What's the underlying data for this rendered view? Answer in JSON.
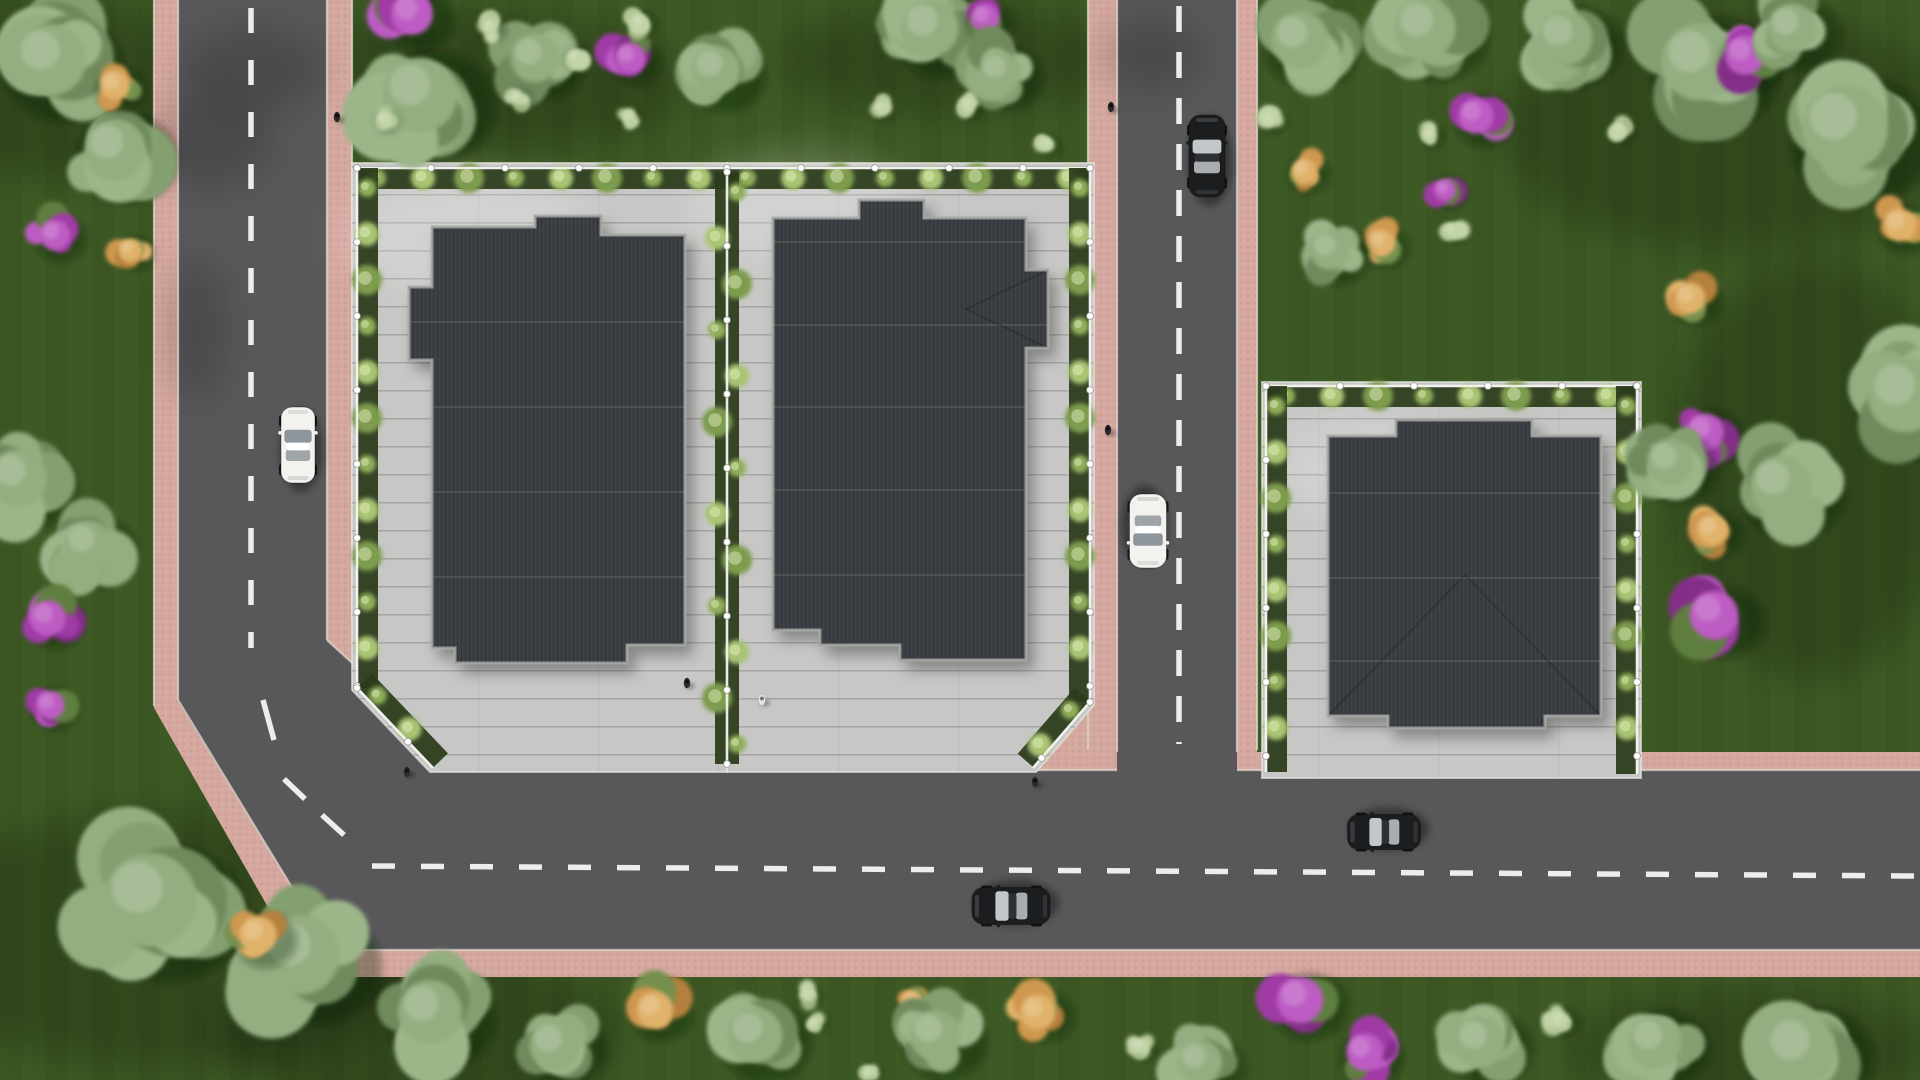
{
  "scene": {
    "width": 1920,
    "height": 1080,
    "description": "Aerial top-down 3D architectural render: three paved plots with dark flat stepped roofs, pink-edged asphalt roads, cars and landscaped lawns"
  },
  "palette": {
    "grass": "#3d5a24",
    "grass_stripe": "rgba(10,28,4,0.05)",
    "grass_shade": "rgba(8,20,3,0.20)",
    "asphalt": "#58585a",
    "asphalt_shade": "rgba(20,22,20,0.16)",
    "sidewalk": "#d5a89f",
    "sidewalk_speckle_dark": "rgba(100,55,48,0.18)",
    "sidewalk_speckle_light": "rgba(255,240,235,0.20)",
    "curb": "#ded2c9",
    "paving": "#c7c7c5",
    "paving_line": "rgba(100,100,98,0.32)",
    "paving_light": "rgba(255,255,255,0.20)",
    "roof": "#3e4144",
    "roof_seam": "rgba(0,0,0,0.20)",
    "roof_joint": "rgba(255,255,255,0.10)",
    "roof_trim": "#a3a7a5",
    "roof_hip": "rgba(0,0,0,0.18)",
    "hedge": "#2c3b1b",
    "hedge_plant_a": "#8fae5a",
    "hedge_plant_b": "#a9c473",
    "hedge_plant_c": "#7d9c4e",
    "fence": "#f4f4f2",
    "fence_post_stroke": "#9a9a96",
    "marking": "#f5f5f3",
    "car_white_body": "#f2f2ef",
    "car_white_glass": "#8f969b",
    "car_black_body": "#1b1d1f",
    "car_black_glass": "#c2c7c9",
    "person_dark": "#2b2b2d",
    "person_light": "#e8e8e6",
    "tree_sage": [
      "#84a071",
      "#93ae80",
      "#6f8a5d",
      "#9cb68a"
    ],
    "bush_light": [
      "#b5c998",
      "#c3d4a8",
      "#9db37e"
    ],
    "bush_orange": [
      "#cf9850",
      "#e0b26b",
      "#b5803c",
      "#74904e"
    ],
    "bush_purple": [
      "#a03ba6",
      "#bd5cc3",
      "#832f88",
      "#5e7f3f"
    ]
  },
  "roads": {
    "sidewalk_polygons": [
      {
        "name": "l-road-sidewalk",
        "points": [
          [
            154,
            0
          ],
          [
            352,
            0
          ],
          [
            352,
            622
          ],
          [
            470,
            752
          ],
          [
            1920,
            752
          ],
          [
            1920,
            977
          ],
          [
            308,
            977
          ],
          [
            154,
            708
          ]
        ]
      },
      {
        "name": "vertical-road-sidewalk",
        "points": [
          [
            1088,
            0
          ],
          [
            1257,
            0
          ],
          [
            1257,
            752
          ],
          [
            1088,
            752
          ]
        ]
      },
      {
        "name": "junction-corner-sidewalk-wedge",
        "points": [
          [
            1033,
            775
          ],
          [
            1098,
            700
          ],
          [
            1120,
            775
          ]
        ]
      }
    ],
    "asphalt_polygons": [
      {
        "name": "l-road-asphalt",
        "points": [
          [
            178,
            0
          ],
          [
            327,
            0
          ],
          [
            327,
            640
          ],
          [
            470,
            770
          ],
          [
            1920,
            770
          ],
          [
            1920,
            950
          ],
          [
            330,
            950
          ],
          [
            178,
            702
          ]
        ]
      },
      {
        "name": "vertical-road-asphalt",
        "points": [
          [
            1117,
            0
          ],
          [
            1237,
            0
          ],
          [
            1237,
            770
          ],
          [
            1117,
            770
          ]
        ]
      }
    ],
    "curb_lines": [
      [
        178,
        0,
        178,
        700
      ],
      [
        327,
        0,
        327,
        640
      ],
      [
        327,
        640,
        470,
        770
      ],
      [
        178,
        700,
        330,
        950
      ],
      [
        330,
        950,
        1920,
        950
      ],
      [
        470,
        770,
        1117,
        770
      ],
      [
        1237,
        770,
        1920,
        770
      ],
      [
        1117,
        0,
        1117,
        752
      ],
      [
        1237,
        0,
        1237,
        752
      ],
      [
        154,
        0,
        154,
        706
      ],
      [
        352,
        0,
        352,
        620
      ],
      [
        1088,
        0,
        1088,
        750
      ],
      [
        1257,
        0,
        1257,
        750
      ]
    ],
    "center_dash_lines": [
      {
        "name": "left-road-center-line",
        "x1": 251,
        "y1": 8,
        "x2": 251,
        "y2": 648,
        "dash": "25 27"
      },
      {
        "name": "vertical-road-center-line",
        "x1": 1179,
        "y1": 6,
        "x2": 1179,
        "y2": 744,
        "dash": "26 20"
      },
      {
        "name": "horizontal-road-center-line",
        "x1": 372,
        "y1": 866,
        "x2": 1914,
        "y2": 876,
        "dash": "23 26"
      },
      {
        "name": "bend-dash-1",
        "x1": 263,
        "y1": 700,
        "x2": 274,
        "y2": 740,
        "dash": "none"
      },
      {
        "name": "bend-dash-2",
        "x1": 284,
        "y1": 779,
        "x2": 305,
        "y2": 799,
        "dash": "none"
      },
      {
        "name": "bend-dash-3",
        "x1": 322,
        "y1": 815,
        "x2": 344,
        "y2": 835,
        "dash": "none"
      }
    ],
    "tree_shadows_on_asphalt": [
      {
        "x": 210,
        "y": 140,
        "rx": 62,
        "ry": 48
      },
      {
        "x": 196,
        "y": 330,
        "rx": 30,
        "ry": 72
      },
      {
        "x": 252,
        "y": 70,
        "rx": 72,
        "ry": 42
      },
      {
        "x": 1150,
        "y": 55,
        "rx": 52,
        "ry": 36
      }
    ]
  },
  "plots": [
    {
      "name": "plot-1",
      "points": [
        [
          352,
          163
        ],
        [
          727,
          163
        ],
        [
          727,
          772
        ],
        [
          430,
          772
        ],
        [
          352,
          690
        ]
      ]
    },
    {
      "name": "plot-2",
      "points": [
        [
          727,
          163
        ],
        [
          1094,
          163
        ],
        [
          1094,
          705
        ],
        [
          1036,
          772
        ],
        [
          727,
          772
        ]
      ]
    },
    {
      "name": "plot-3",
      "points": [
        [
          1262,
          382
        ],
        [
          1641,
          382
        ],
        [
          1641,
          778
        ],
        [
          1262,
          778
        ]
      ]
    }
  ],
  "paving_light_patches": [
    {
      "x": 470,
      "y": 235,
      "rx": 125,
      "ry": 62
    },
    {
      "x": 800,
      "y": 205,
      "rx": 110,
      "ry": 55
    },
    {
      "x": 1380,
      "y": 470,
      "rx": 100,
      "ry": 50
    }
  ],
  "grass_shade_patches": [
    {
      "x": 450,
      "y": 85,
      "rx": 240,
      "ry": 70
    },
    {
      "x": 950,
      "y": 60,
      "rx": 170,
      "ry": 55
    },
    {
      "x": 1730,
      "y": 130,
      "rx": 230,
      "ry": 120
    },
    {
      "x": 170,
      "y": 940,
      "rx": 260,
      "ry": 130
    },
    {
      "x": 1810,
      "y": 470,
      "rx": 140,
      "ry": 210
    },
    {
      "x": 60,
      "y": 90,
      "rx": 140,
      "ry": 90
    },
    {
      "x": 420,
      "y": 1030,
      "rx": 200,
      "ry": 80
    },
    {
      "x": 1750,
      "y": 1050,
      "rx": 180,
      "ry": 60
    }
  ],
  "fences": [
    {
      "name": "plot1-top-fence",
      "x1": 357,
      "y1": 168,
      "x2": 727,
      "y2": 168,
      "nx": 0,
      "ny": 1
    },
    {
      "name": "plot1-left-fence",
      "x1": 357,
      "y1": 168,
      "x2": 357,
      "y2": 688,
      "nx": 1,
      "ny": 0
    },
    {
      "name": "plot1-corner-fence",
      "x1": 357,
      "y1": 688,
      "x2": 433,
      "y2": 768,
      "nx": 0.7,
      "ny": -0.7
    },
    {
      "name": "plot2-top-fence",
      "x1": 727,
      "y1": 168,
      "x2": 1090,
      "y2": 168,
      "nx": 0,
      "ny": 1
    },
    {
      "name": "plot2-right-fence",
      "x1": 1090,
      "y1": 168,
      "x2": 1090,
      "y2": 702,
      "nx": -1,
      "ny": 0
    },
    {
      "name": "plot2-corner-fence",
      "x1": 1090,
      "y1": 702,
      "x2": 1033,
      "y2": 768,
      "nx": -0.7,
      "ny": -0.7
    },
    {
      "name": "interplot-fence",
      "x1": 727,
      "y1": 172,
      "x2": 727,
      "y2": 764,
      "nx": 0,
      "ny": 0
    },
    {
      "name": "plot3-top-fence",
      "x1": 1266,
      "y1": 386,
      "x2": 1637,
      "y2": 386,
      "nx": 0,
      "ny": 1
    },
    {
      "name": "plot3-left-fence",
      "x1": 1266,
      "y1": 386,
      "x2": 1266,
      "y2": 772,
      "nx": 1,
      "ny": 0
    },
    {
      "name": "plot3-right-fence",
      "x1": 1637,
      "y1": 386,
      "x2": 1637,
      "y2": 774,
      "nx": -1,
      "ny": 0
    }
  ],
  "buildings": [
    {
      "name": "building-1-roof",
      "points": [
        [
          432,
          227
        ],
        [
          535,
          227
        ],
        [
          535,
          216
        ],
        [
          601,
          216
        ],
        [
          601,
          235
        ],
        [
          685,
          235
        ],
        [
          685,
          645
        ],
        [
          627,
          645
        ],
        [
          627,
          663
        ],
        [
          455,
          663
        ],
        [
          455,
          648
        ],
        [
          432,
          648
        ],
        [
          432,
          360
        ],
        [
          409,
          360
        ],
        [
          409,
          287
        ],
        [
          432,
          287
        ]
      ],
      "joint_lines_y": [
        322,
        407,
        492,
        577
      ],
      "hips": []
    },
    {
      "name": "building-2-roof",
      "points": [
        [
          773,
          218
        ],
        [
          859,
          218
        ],
        [
          859,
          200
        ],
        [
          924,
          200
        ],
        [
          924,
          218
        ],
        [
          1026,
          218
        ],
        [
          1026,
          270
        ],
        [
          1048,
          270
        ],
        [
          1048,
          348
        ],
        [
          1026,
          348
        ],
        [
          1026,
          660
        ],
        [
          900,
          660
        ],
        [
          900,
          645
        ],
        [
          820,
          645
        ],
        [
          820,
          630
        ],
        [
          773,
          630
        ]
      ],
      "joint_lines_y": [
        242,
        325,
        407,
        490,
        575
      ],
      "hips": [
        [
          1048,
          270,
          966,
          309
        ],
        [
          1048,
          348,
          966,
          309
        ]
      ]
    },
    {
      "name": "building-3-roof",
      "points": [
        [
          1328,
          436
        ],
        [
          1396,
          436
        ],
        [
          1396,
          420
        ],
        [
          1532,
          420
        ],
        [
          1532,
          436
        ],
        [
          1601,
          436
        ],
        [
          1601,
          716
        ],
        [
          1545,
          716
        ],
        [
          1545,
          728
        ],
        [
          1388,
          728
        ],
        [
          1388,
          716
        ],
        [
          1328,
          716
        ]
      ],
      "joint_lines_y": [
        493,
        578,
        661
      ],
      "hips": [
        [
          1328,
          716,
          1465,
          575
        ],
        [
          1601,
          716,
          1465,
          575
        ]
      ]
    }
  ],
  "vegetation": [
    [
      "tree",
      50,
      60,
      65
    ],
    [
      "tree",
      115,
      150,
      56
    ],
    [
      "orange",
      115,
      85,
      27
    ],
    [
      "orange",
      130,
      250,
      21
    ],
    [
      "purple",
      55,
      235,
      28
    ],
    [
      "tree",
      18,
      478,
      52
    ],
    [
      "tree",
      88,
      545,
      44
    ],
    [
      "purple",
      48,
      618,
      32
    ],
    [
      "purple",
      50,
      705,
      26
    ],
    [
      "tree",
      150,
      900,
      85
    ],
    [
      "tree",
      300,
      955,
      72
    ],
    [
      "orange",
      258,
      935,
      34
    ],
    [
      "tree",
      430,
      1012,
      58
    ],
    [
      "tree",
      555,
      1045,
      46
    ],
    [
      "purple",
      412,
      14,
      38
    ],
    [
      "tree",
      420,
      95,
      68
    ],
    [
      "tree",
      535,
      58,
      44
    ],
    [
      "bush",
      490,
      27,
      15
    ],
    [
      "bush",
      517,
      97,
      13
    ],
    [
      "bush",
      385,
      120,
      13
    ],
    [
      "bush",
      575,
      57,
      15
    ],
    [
      "purple",
      630,
      58,
      28
    ],
    [
      "bush",
      640,
      22,
      15
    ],
    [
      "bush",
      628,
      117,
      12
    ],
    [
      "orange",
      700,
      63,
      13
    ],
    [
      "tree",
      716,
      70,
      44
    ],
    [
      "tree",
      930,
      28,
      52
    ],
    [
      "purple",
      985,
      18,
      26
    ],
    [
      "bush",
      992,
      55,
      14
    ],
    [
      "bush",
      968,
      106,
      13
    ],
    [
      "bush",
      880,
      108,
      12
    ],
    [
      "tree",
      1000,
      72,
      38
    ],
    [
      "bush",
      1048,
      145,
      12
    ],
    [
      "tree",
      1300,
      40,
      52
    ],
    [
      "tree",
      1425,
      28,
      56
    ],
    [
      "tree",
      1565,
      38,
      50
    ],
    [
      "tree",
      1700,
      62,
      70
    ],
    [
      "purple",
      1745,
      55,
      36
    ],
    [
      "tree",
      1792,
      28,
      44
    ],
    [
      "tree",
      1845,
      128,
      78
    ],
    [
      "bush",
      1270,
      120,
      14
    ],
    [
      "purple",
      1476,
      116,
      32
    ],
    [
      "purple",
      1445,
      190,
      20
    ],
    [
      "bush",
      1430,
      135,
      13
    ],
    [
      "bush",
      1620,
      130,
      13
    ],
    [
      "orange",
      1304,
      171,
      23
    ],
    [
      "orange",
      1381,
      243,
      25
    ],
    [
      "tree",
      1330,
      250,
      36
    ],
    [
      "bush",
      1452,
      230,
      14
    ],
    [
      "orange",
      1690,
      298,
      28
    ],
    [
      "orange",
      1900,
      225,
      30
    ],
    [
      "tree",
      1905,
      395,
      68
    ],
    [
      "purple",
      1705,
      432,
      34
    ],
    [
      "orange",
      1712,
      530,
      28
    ],
    [
      "purple",
      1714,
      615,
      44
    ],
    [
      "tree",
      1781,
      486,
      56
    ],
    [
      "tree",
      1670,
      462,
      42
    ],
    [
      "orange",
      655,
      1010,
      33
    ],
    [
      "tree",
      755,
      1035,
      50
    ],
    [
      "bush",
      808,
      995,
      12
    ],
    [
      "bush",
      815,
      1022,
      11
    ],
    [
      "orange",
      912,
      1000,
      18
    ],
    [
      "tree",
      935,
      1035,
      46
    ],
    [
      "orange",
      1038,
      1012,
      32
    ],
    [
      "bush",
      1140,
      1046,
      15
    ],
    [
      "tree",
      1200,
      1062,
      40
    ],
    [
      "purple",
      1300,
      1000,
      42
    ],
    [
      "purple",
      1365,
      1052,
      34
    ],
    [
      "tree",
      1480,
      1042,
      46
    ],
    [
      "bush",
      1560,
      1020,
      17
    ],
    [
      "tree",
      1655,
      1042,
      48
    ],
    [
      "tree",
      1800,
      1050,
      66
    ],
    [
      "bush",
      868,
      1072,
      11
    ]
  ],
  "cars": [
    {
      "name": "white-car-left-road",
      "color": "white",
      "x": 298,
      "y": 445,
      "len": 76,
      "wid": 34,
      "heading": "N"
    },
    {
      "name": "black-car-vertical-road-top",
      "color": "black",
      "x": 1207,
      "y": 156,
      "len": 82,
      "wid": 36,
      "heading": "N"
    },
    {
      "name": "white-car-vertical-road",
      "color": "white",
      "x": 1148,
      "y": 531,
      "len": 74,
      "wid": 37,
      "heading": "S"
    },
    {
      "name": "black-car-horizontal-road-1",
      "color": "black",
      "x": 1011,
      "y": 906,
      "len": 78,
      "wid": 37,
      "heading": "W"
    },
    {
      "name": "black-car-horizontal-road-2",
      "color": "black",
      "x": 1384,
      "y": 832,
      "len": 73,
      "wid": 35,
      "heading": "W"
    }
  ],
  "people": [
    {
      "name": "pedestrian-left-sidewalk",
      "x": 337,
      "y": 117,
      "tone": "dark"
    },
    {
      "name": "pedestrian-vertical-road-top",
      "x": 1111,
      "y": 107,
      "tone": "dark"
    },
    {
      "name": "pedestrian-vertical-road-mid",
      "x": 1108,
      "y": 430,
      "tone": "dark"
    },
    {
      "name": "pedestrian-plot1-paving",
      "x": 687,
      "y": 683,
      "tone": "dark"
    },
    {
      "name": "pedestrian-plot2-paving",
      "x": 762,
      "y": 700,
      "tone": "light"
    },
    {
      "name": "pedestrian-plot2-corner",
      "x": 1035,
      "y": 782,
      "tone": "dark"
    },
    {
      "name": "pedestrian-plot1-corner",
      "x": 407,
      "y": 772,
      "tone": "dark"
    }
  ]
}
